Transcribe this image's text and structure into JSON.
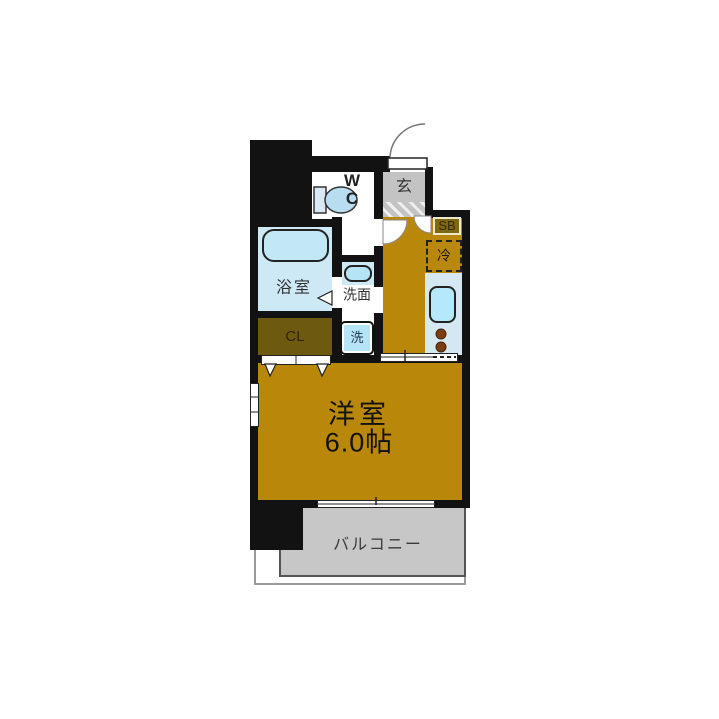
{
  "colors": {
    "wall": "#121212",
    "floor": "#b9870a",
    "closet": "#6e5a0e",
    "water-blue": "#cde9f6",
    "fixture-blue": "#b5e4f6",
    "counter-blue": "#d5e7f2",
    "genkan-gray": "#c3c3c3",
    "balcony-gray": "#c7c7c7",
    "burner-brown": "#7a3f10",
    "shoebox-olive": "#7d680e"
  },
  "rooms": {
    "wc": {
      "line1": "W",
      "line2": "C"
    },
    "entrance": {
      "label": "玄"
    },
    "shoe_box": {
      "label": "SB"
    },
    "refrigerator": {
      "label": "冷"
    },
    "bathroom": {
      "label": "浴室"
    },
    "washroom": {
      "label": "洗面"
    },
    "washer": {
      "label": "洗"
    },
    "closet": {
      "label": "CL"
    },
    "main_room": {
      "name": "洋室",
      "size": "6.0帖"
    },
    "balcony": {
      "label": "バルコニー"
    }
  }
}
